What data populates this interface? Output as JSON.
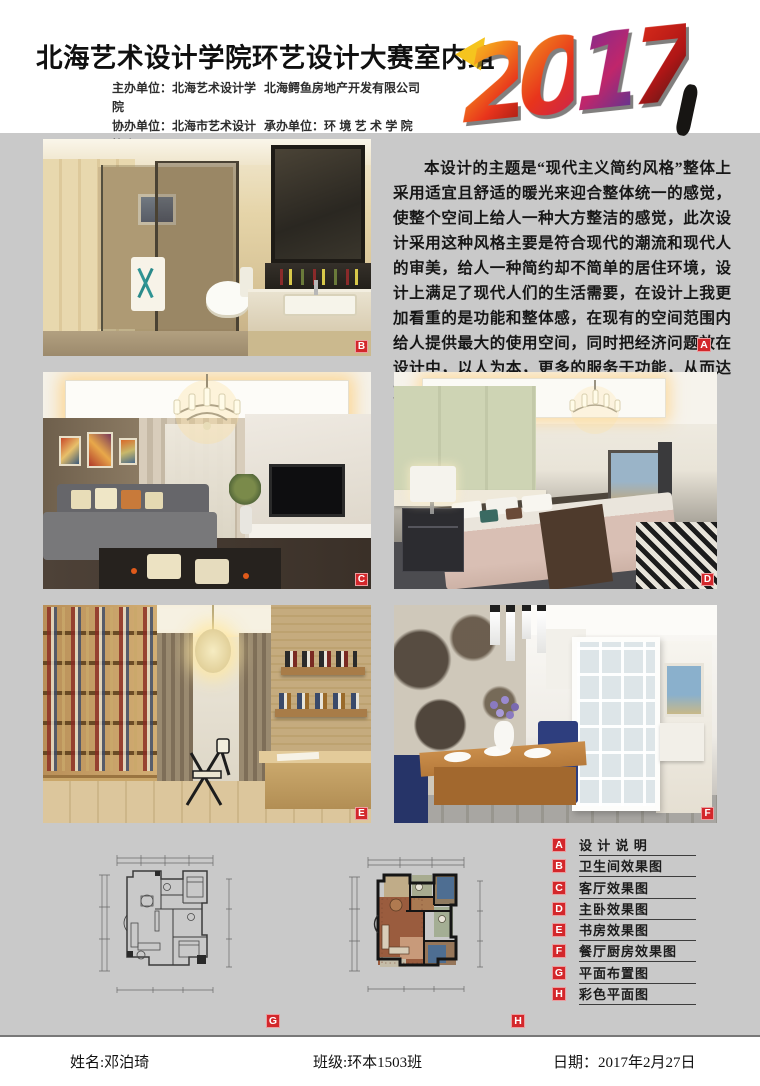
{
  "colors": {
    "page_bg": "#c9c9c9",
    "accent_red": "#d3272b",
    "ink": "#101010"
  },
  "header": {
    "title": "北海艺术设计学院环艺设计大赛室内组",
    "year": "2017",
    "year_digits": [
      "2",
      "0",
      "1",
      "7"
    ],
    "organizers": {
      "line1_left": "主办单位：北海艺术设计学院",
      "line1_right": "北海鳄鱼房地产开发有限公司",
      "line2_left": "协办单位：北海市艺术设计协会",
      "line2_right": "承办单位：环 境 艺 术 学 院"
    }
  },
  "description": {
    "label": "A",
    "text": "本设计的主题是“现代主义简约风格”整体上采用适宜且舒适的暖光来迎合整体统一的感觉，使整个空间上给人一种大方整洁的感觉，此次设计采用这种风格主要是符合现代的潮流和现代人的审美，给人一种简约却不简单的居住环境，设计上满足了现代人们的生活需要，在设计上我更加看重的是功能和整体感，在现有的空间范围内给人提供最大的使用空间，同时把经济问题放在设计中，以人为本，更多的服务于功能，从而达到实用经济的目的，给人和谐舒适的感觉。"
  },
  "photos": [
    {
      "label": "B"
    },
    {
      "label": "C"
    },
    {
      "label": "D"
    },
    {
      "label": "E"
    },
    {
      "label": "F"
    }
  ],
  "plans": [
    {
      "label": "G"
    },
    {
      "label": "H"
    }
  ],
  "legend": [
    {
      "key": "A",
      "label": "设 计 说 明"
    },
    {
      "key": "B",
      "label": "卫生间效果图"
    },
    {
      "key": "C",
      "label": "客厅效果图"
    },
    {
      "key": "D",
      "label": "主卧效果图"
    },
    {
      "key": "E",
      "label": "书房效果图"
    },
    {
      "key": "F",
      "label": "餐厅厨房效果图"
    },
    {
      "key": "G",
      "label": "平面布置图"
    },
    {
      "key": "H",
      "label": "彩色平面图"
    }
  ],
  "footer": {
    "name": "姓名:邓泊琦",
    "class": "班级:环本1503班",
    "date": "日期：2017年2月27日"
  }
}
